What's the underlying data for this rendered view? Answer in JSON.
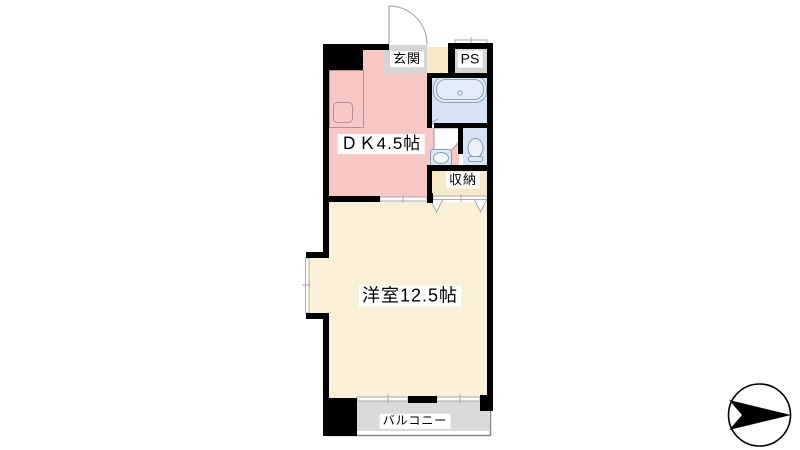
{
  "title": "1DK apartment floor plan",
  "colors": {
    "wall": "#000000",
    "dk_pink": "#F8C8C7",
    "water_blue": "#D5E3F4",
    "tub_fill": "#E2EDF9",
    "fixture_blue": "#DDE9F7",
    "room_cream": "#FAF0D8",
    "closet_beige": "#F5E9C8",
    "entry_gray": "#D5D5D5",
    "balcony_gray": "#DADADA",
    "line_gray": "#9A9A9A",
    "white": "#FFFFFF",
    "compass_black": "#000000"
  },
  "labels": {
    "entrance": "玄関",
    "pipe_space": "PS",
    "dining_kitchen": "ＤＫ4.5帖",
    "storage": "収納",
    "western_room": "洋室12.5帖",
    "balcony": "バルコニー"
  },
  "icons": {
    "compass": "north-arrow-pointing-right",
    "fixtures": [
      "bathtub-icon",
      "kitchen-sink-icon",
      "washbasin-icon",
      "toilet-icon",
      "door-swing-arc",
      "sliding-window-marks",
      "closet-folding-door-marks"
    ]
  }
}
